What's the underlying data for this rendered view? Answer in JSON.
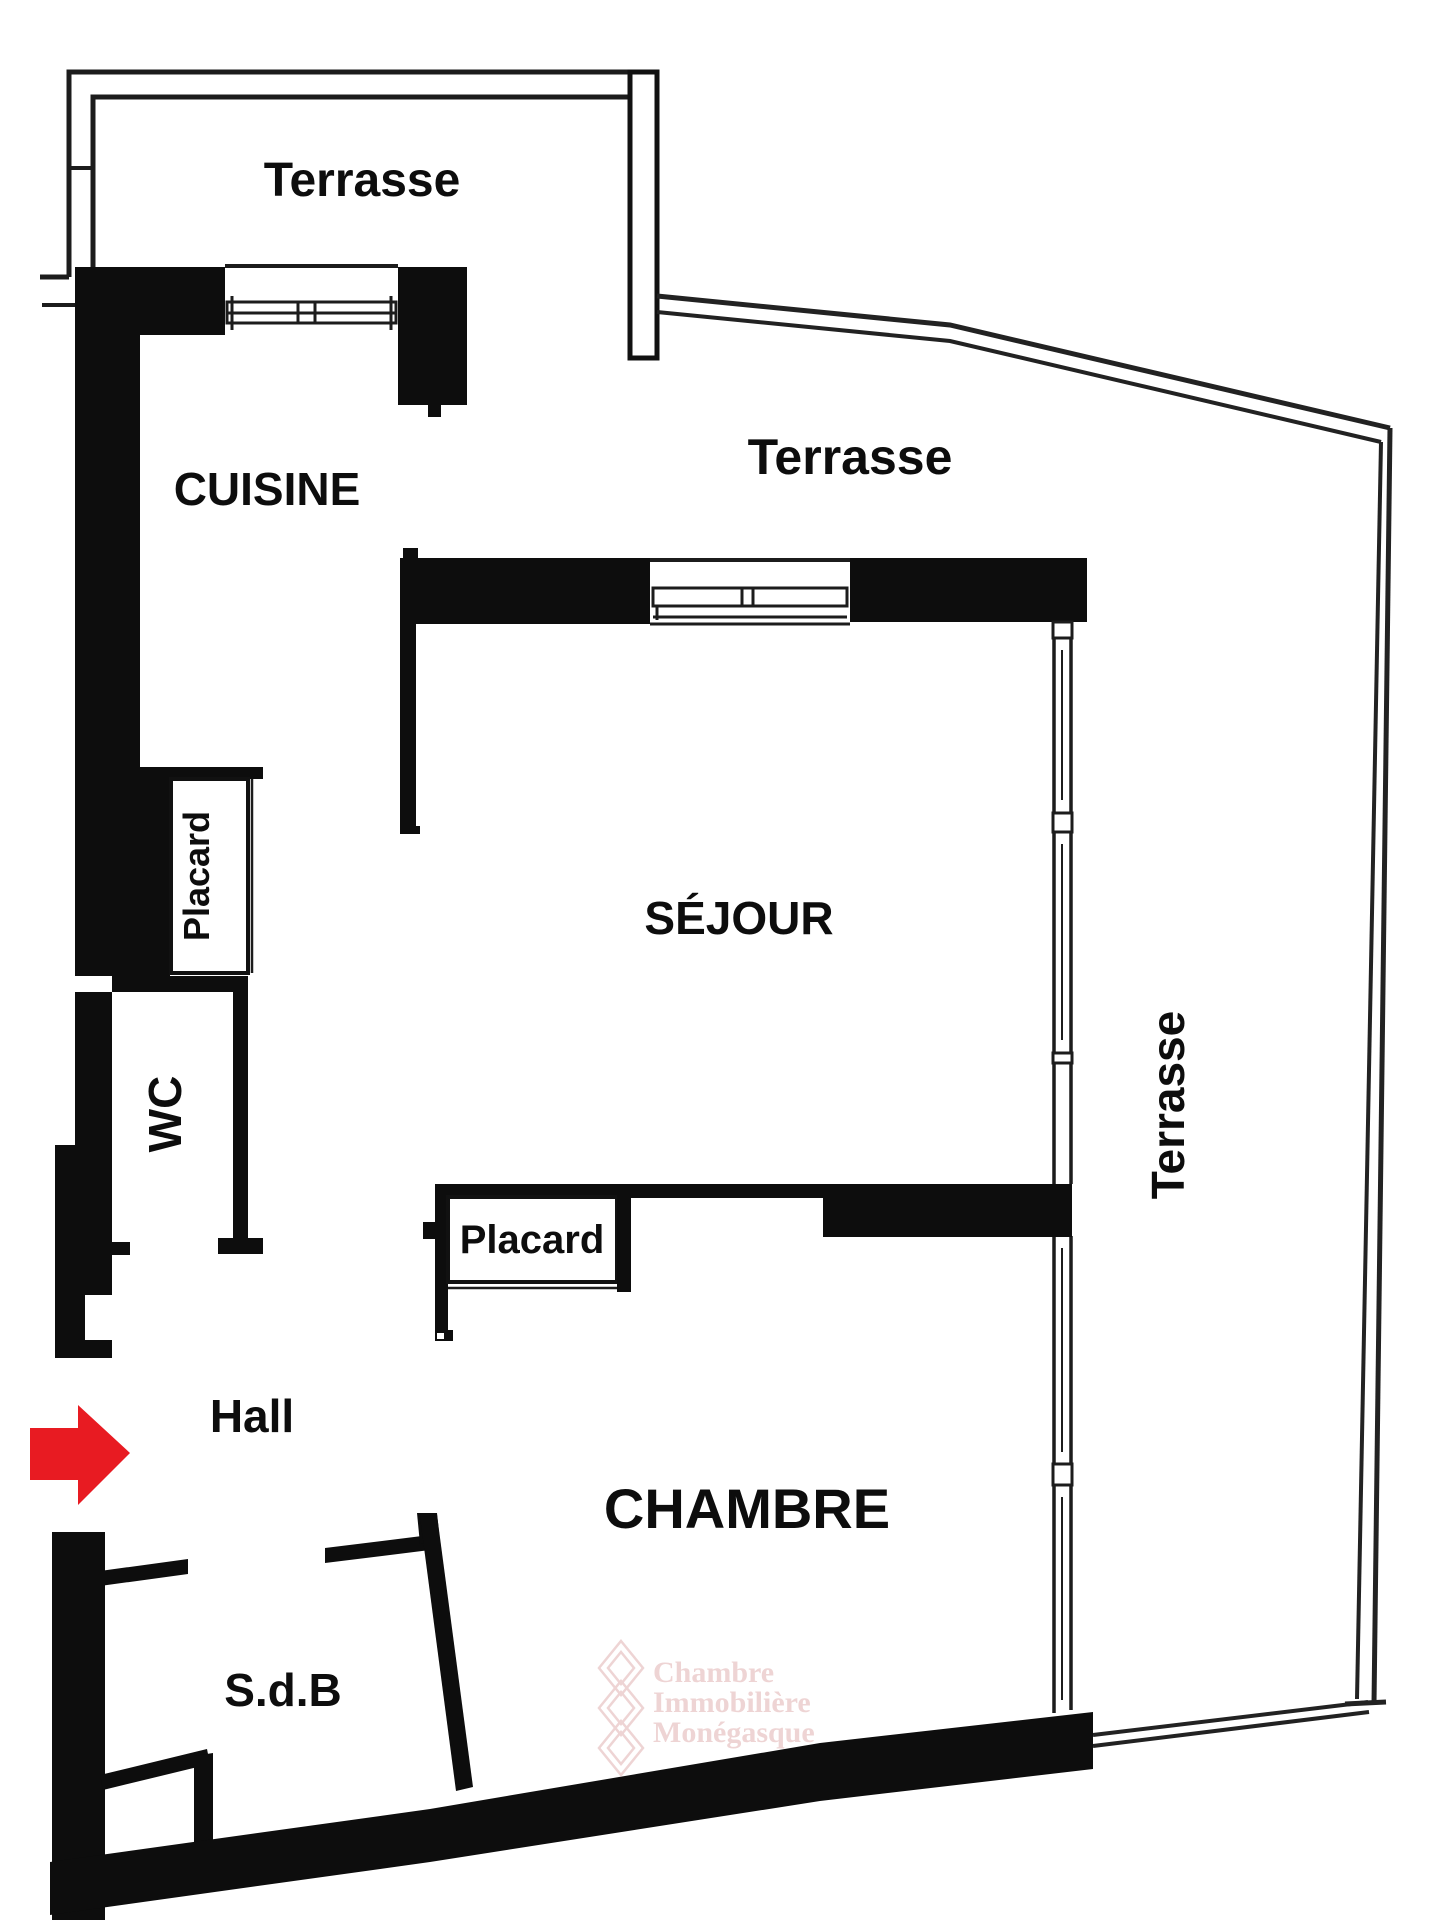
{
  "plan": {
    "title": "apartment-floor-plan",
    "rooms": {
      "terrace_top": {
        "label": "Terrasse"
      },
      "terrace_middle": {
        "label": "Terrasse"
      },
      "terrace_right": {
        "label": "Terrasse"
      },
      "kitchen": {
        "label": "CUISINE"
      },
      "living": {
        "label": "SÉJOUR"
      },
      "hall_closet": {
        "label": "Placard"
      },
      "bedroom_closet": {
        "label": "Placard"
      },
      "wc": {
        "label": "WC"
      },
      "hall": {
        "label": "Hall"
      },
      "bedroom": {
        "label": "CHAMBRE"
      },
      "bathroom": {
        "label": "S.d.B"
      }
    },
    "entrance_arrow": {
      "direction": "right",
      "color": "#e81b22"
    },
    "watermark": {
      "line1": "Chambre",
      "line2": "Immobilière",
      "line3": "Monégasque",
      "color": "#eed4d4"
    },
    "colors": {
      "wall": "#0d0d0d",
      "thin_line": "#1c1c1c",
      "background": "#ffffff"
    }
  }
}
